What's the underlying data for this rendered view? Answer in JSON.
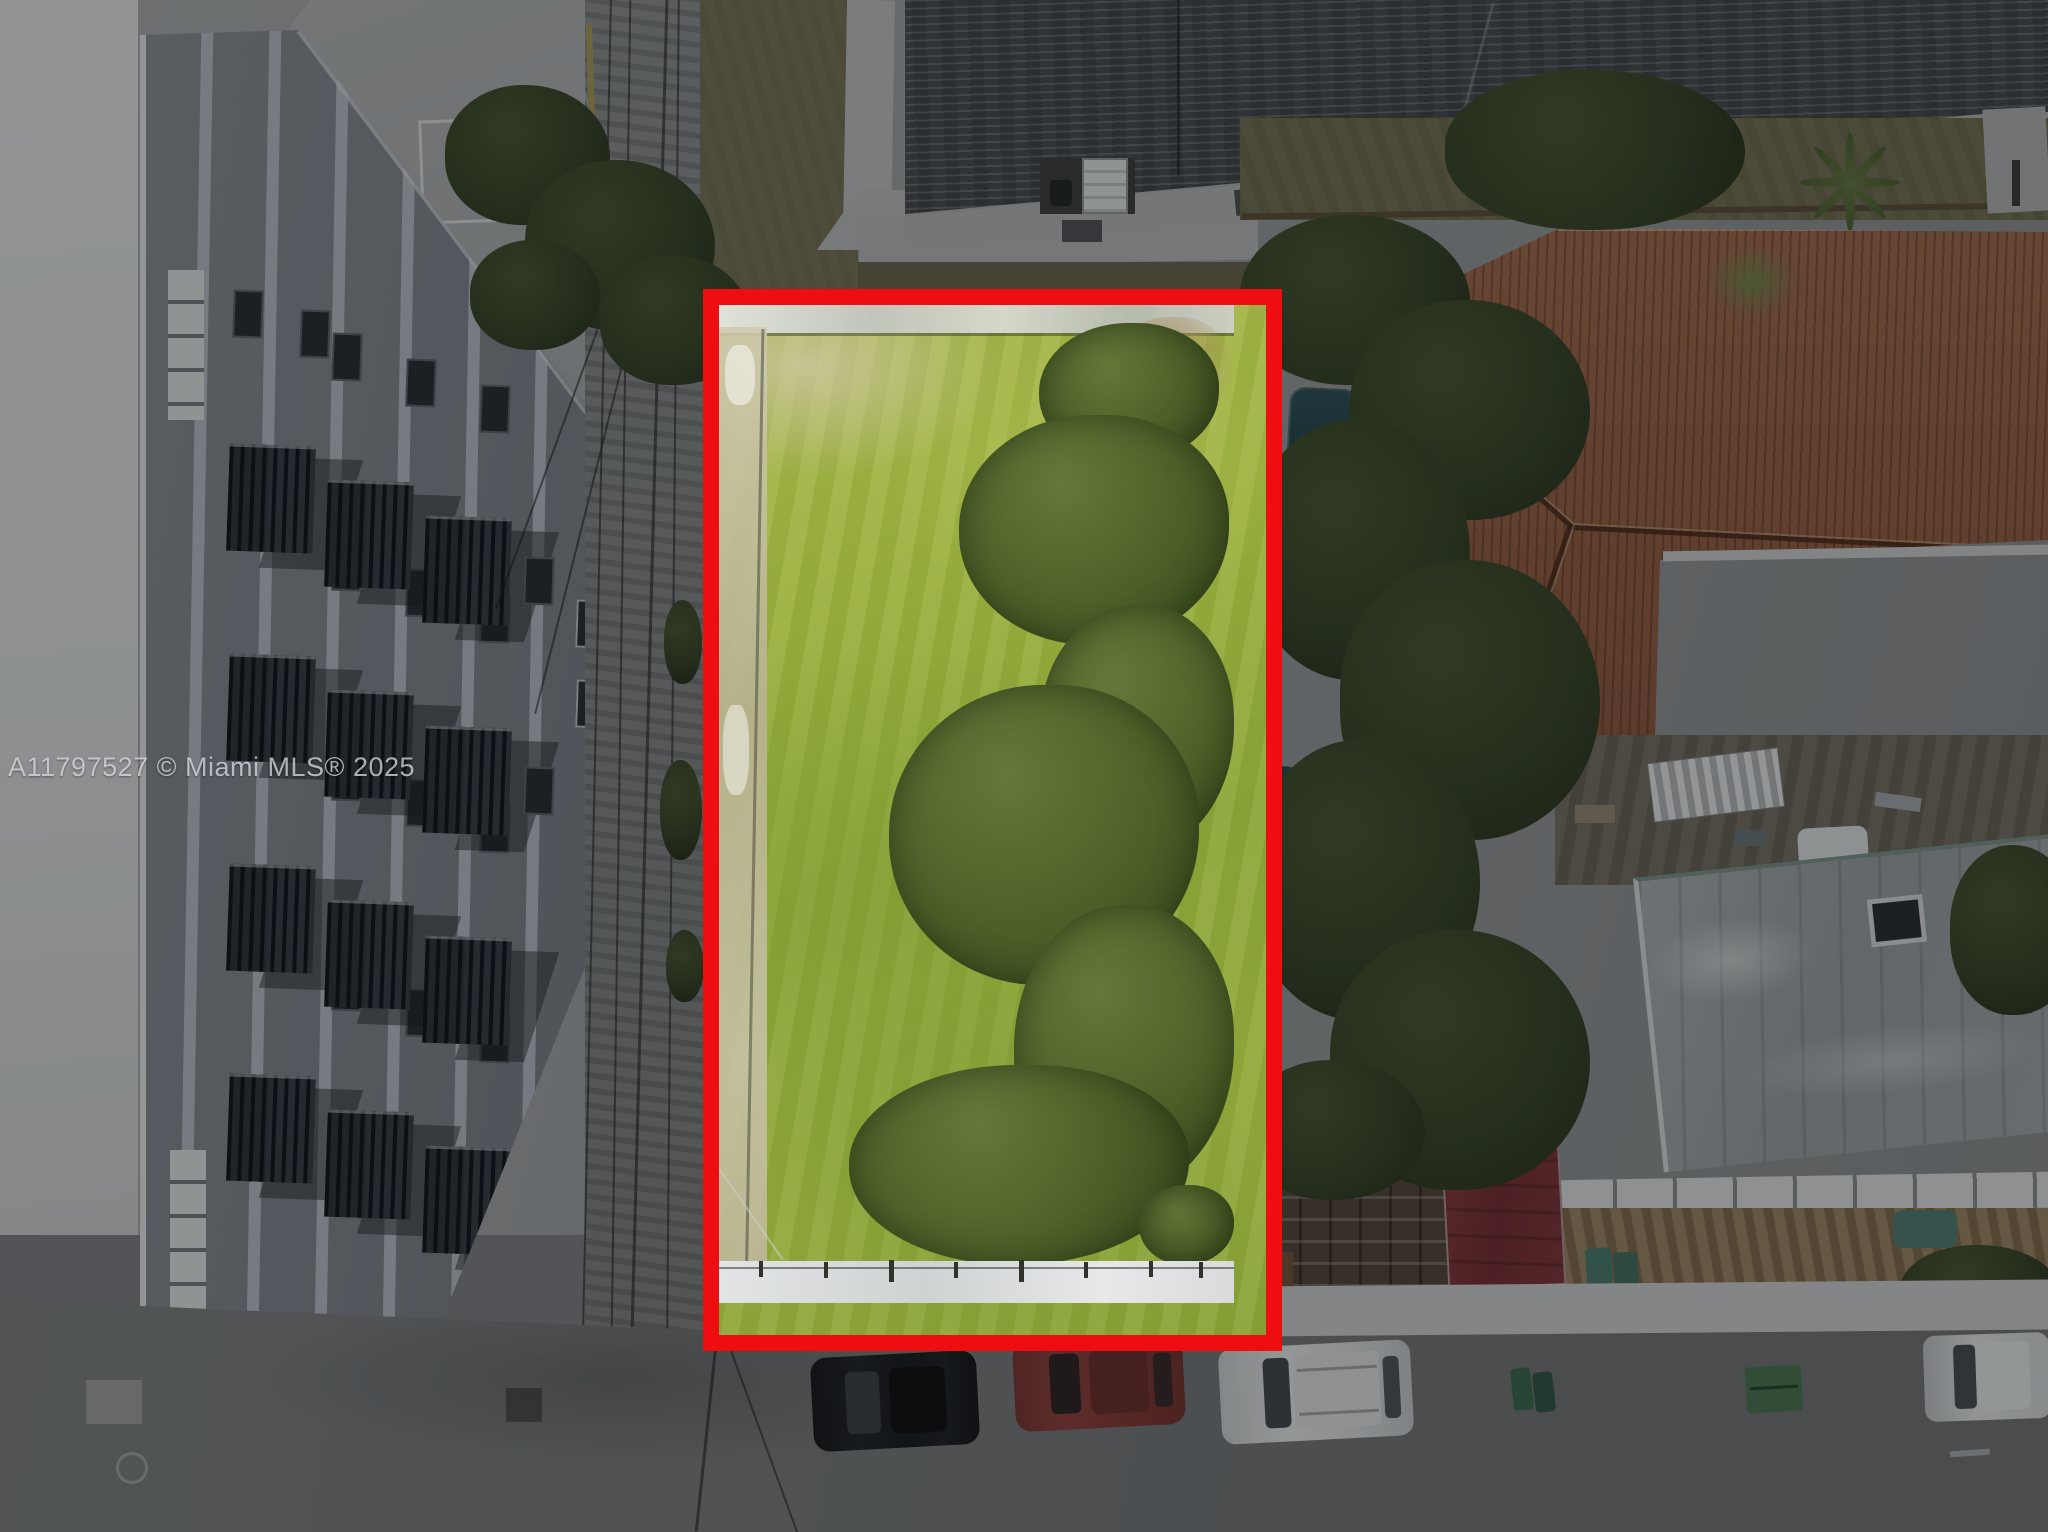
{
  "meta": {
    "type": "aerial-photograph",
    "subject": "Top-down drone photo of a vacant grass lot outlined with a red property boundary, surrounded by darkened neighborhood"
  },
  "watermark": {
    "text": "A11797527 © Miami MLS® 2025"
  },
  "highlight": {
    "label": "property-boundary",
    "color": "#ee0d10"
  },
  "palette": {
    "boundary_red": "#ee0d10",
    "lot_grass": "#9ab03e",
    "lot_trees": "#4c5f28",
    "outside_trees": "#2e3a20",
    "street": "#515356",
    "apartment_building": "#565a61",
    "tile_roof": "#6e4936",
    "shingle_roof": "#3a3d40",
    "flat_roof": "#6a6d70",
    "red_awning": "#58262a",
    "sidewalk": "#8f9193"
  },
  "objects": [
    "vacant-lot",
    "red-boundary",
    "apartment-building",
    "alley-street",
    "shingle-roof-house",
    "tile-roof-house",
    "flat-roof-building",
    "red-awning",
    "pergola",
    "palm-tree",
    "tree-canopy",
    "black-car",
    "maroon-car",
    "white-suv",
    "white-suv-right",
    "green-bins",
    "green-dumpster",
    "street",
    "sidewalk",
    "watermark"
  ]
}
